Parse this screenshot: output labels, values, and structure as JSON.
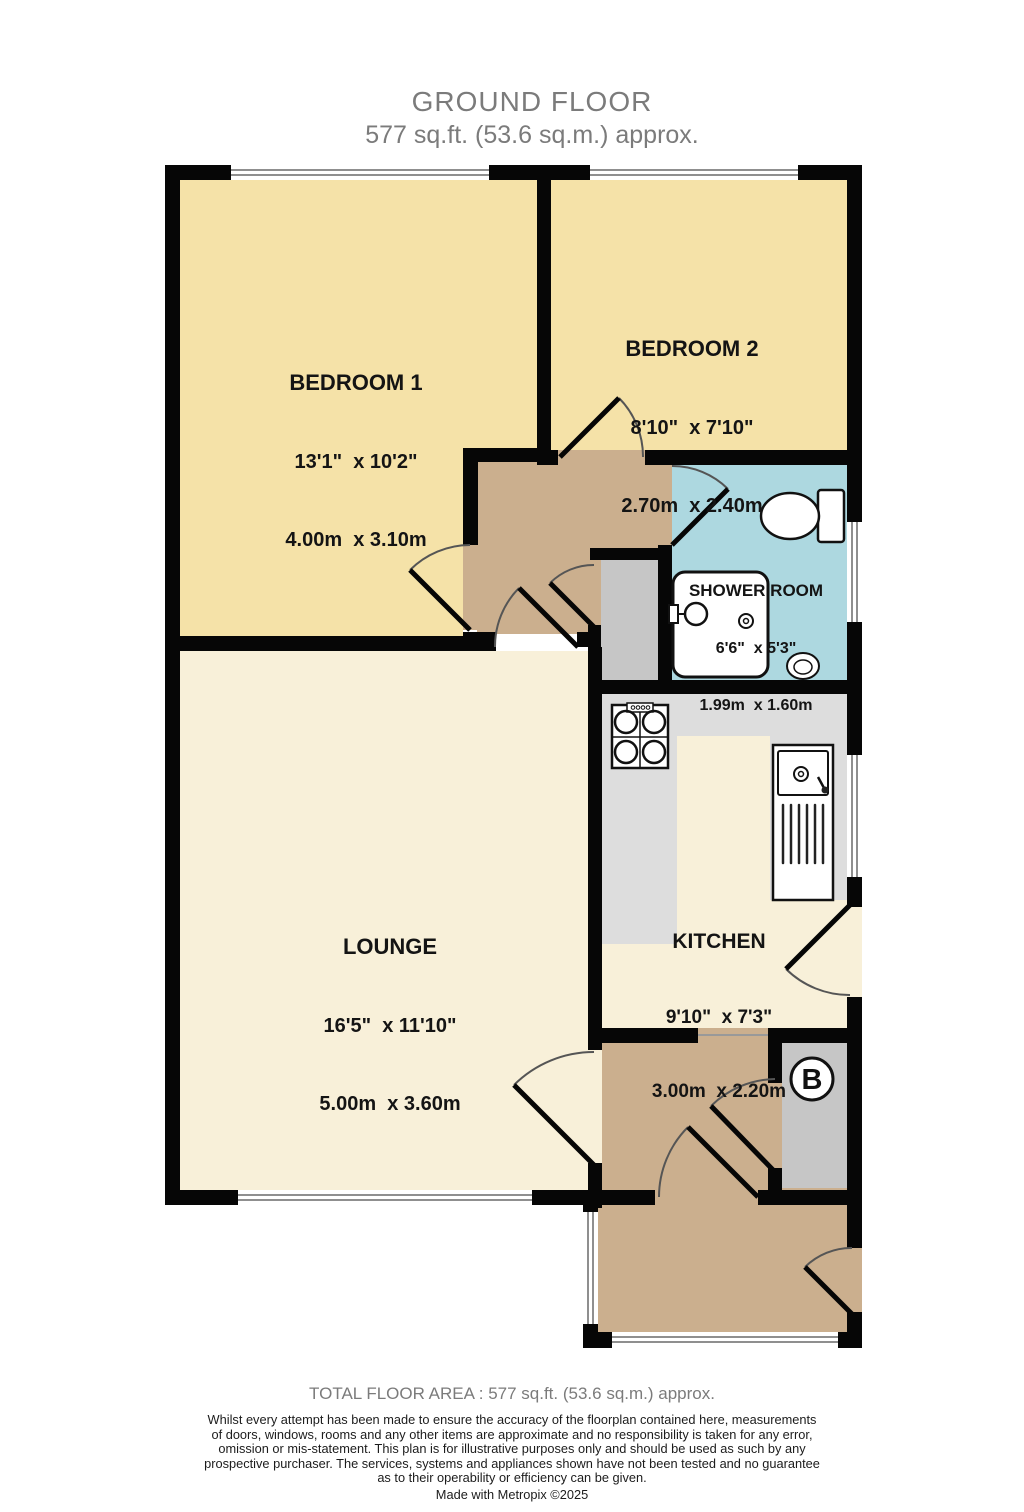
{
  "title": {
    "line1": "GROUND FLOOR",
    "line2": "577 sq.ft. (53.6 sq.m.) approx."
  },
  "rooms": {
    "bedroom1": {
      "name": "BEDROOM 1",
      "imperial": "13'1\"  x 10'2\"",
      "metric": "4.00m  x 3.10m"
    },
    "bedroom2": {
      "name": "BEDROOM 2",
      "imperial": "8'10\"  x 7'10\"",
      "metric": "2.70m  x 2.40m"
    },
    "shower": {
      "name": "SHOWER ROOM",
      "imperial": "6'6\"  x 5'3\"",
      "metric": "1.99m  x 1.60m"
    },
    "lounge": {
      "name": "LOUNGE",
      "imperial": "16'5\"  x 11'10\"",
      "metric": "5.00m  x 3.60m"
    },
    "kitchen": {
      "name": "KITCHEN",
      "imperial": "9'10\"  x 7'3\"",
      "metric": "3.00m  x 2.20m"
    }
  },
  "labels": {
    "boiler": "B"
  },
  "footer": {
    "total": "TOTAL FLOOR AREA : 577 sq.ft. (53.6 sq.m.) approx.",
    "disclaimer_lines": [
      "Whilst every attempt has been made to ensure the accuracy of the floorplan contained here, measurements",
      "of doors, windows, rooms and any other items are approximate and no responsibility is taken for any error,",
      "omission or mis-statement. This plan is for illustrative purposes only and should be used as such by any",
      "prospective purchaser. The services, systems and appliances shown have not been tested and no guarantee",
      "as to their operability or efficiency can be given."
    ],
    "credit": "Made with Metropix ©2025"
  },
  "colors": {
    "wall": "#060606",
    "bedroom_yellow": "#F5E2A8",
    "lounge_cream": "#F8F0D9",
    "hall_tan": "#CBAF8E",
    "shower_blue": "#ADD8E0",
    "cupboard_gray": "#C6C6C6",
    "counter_gray": "#DDDDDD",
    "title_gray": "#7B7B7B"
  }
}
